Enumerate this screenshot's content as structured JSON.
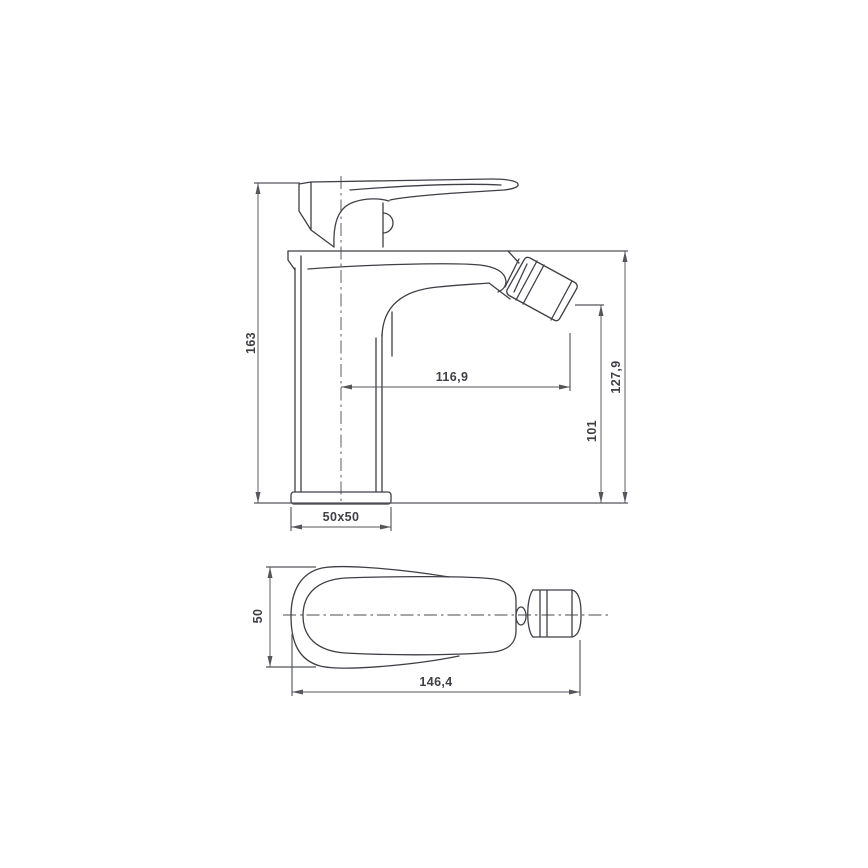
{
  "page": {
    "background": "#ffffff"
  },
  "drawing": {
    "kind": "technical-dimension-drawing",
    "subject": "single-lever bidet mixer tap",
    "views": {
      "side": "side-elevation",
      "top": "top-plan"
    }
  },
  "colors": {
    "outline": "#3f3f46",
    "dimension_lines": "#55565a",
    "text": "#3f3f46",
    "background": "#ffffff"
  },
  "dimensions": {
    "total_height": {
      "label": "163"
    },
    "spout_reach": {
      "label": "116,9"
    },
    "spout_top_height": {
      "label": "127,9"
    },
    "outlet_height": {
      "label": "101"
    },
    "base_footprint": {
      "label": "50x50"
    },
    "body_width": {
      "label": "50"
    },
    "total_length": {
      "label": "146,4"
    }
  }
}
